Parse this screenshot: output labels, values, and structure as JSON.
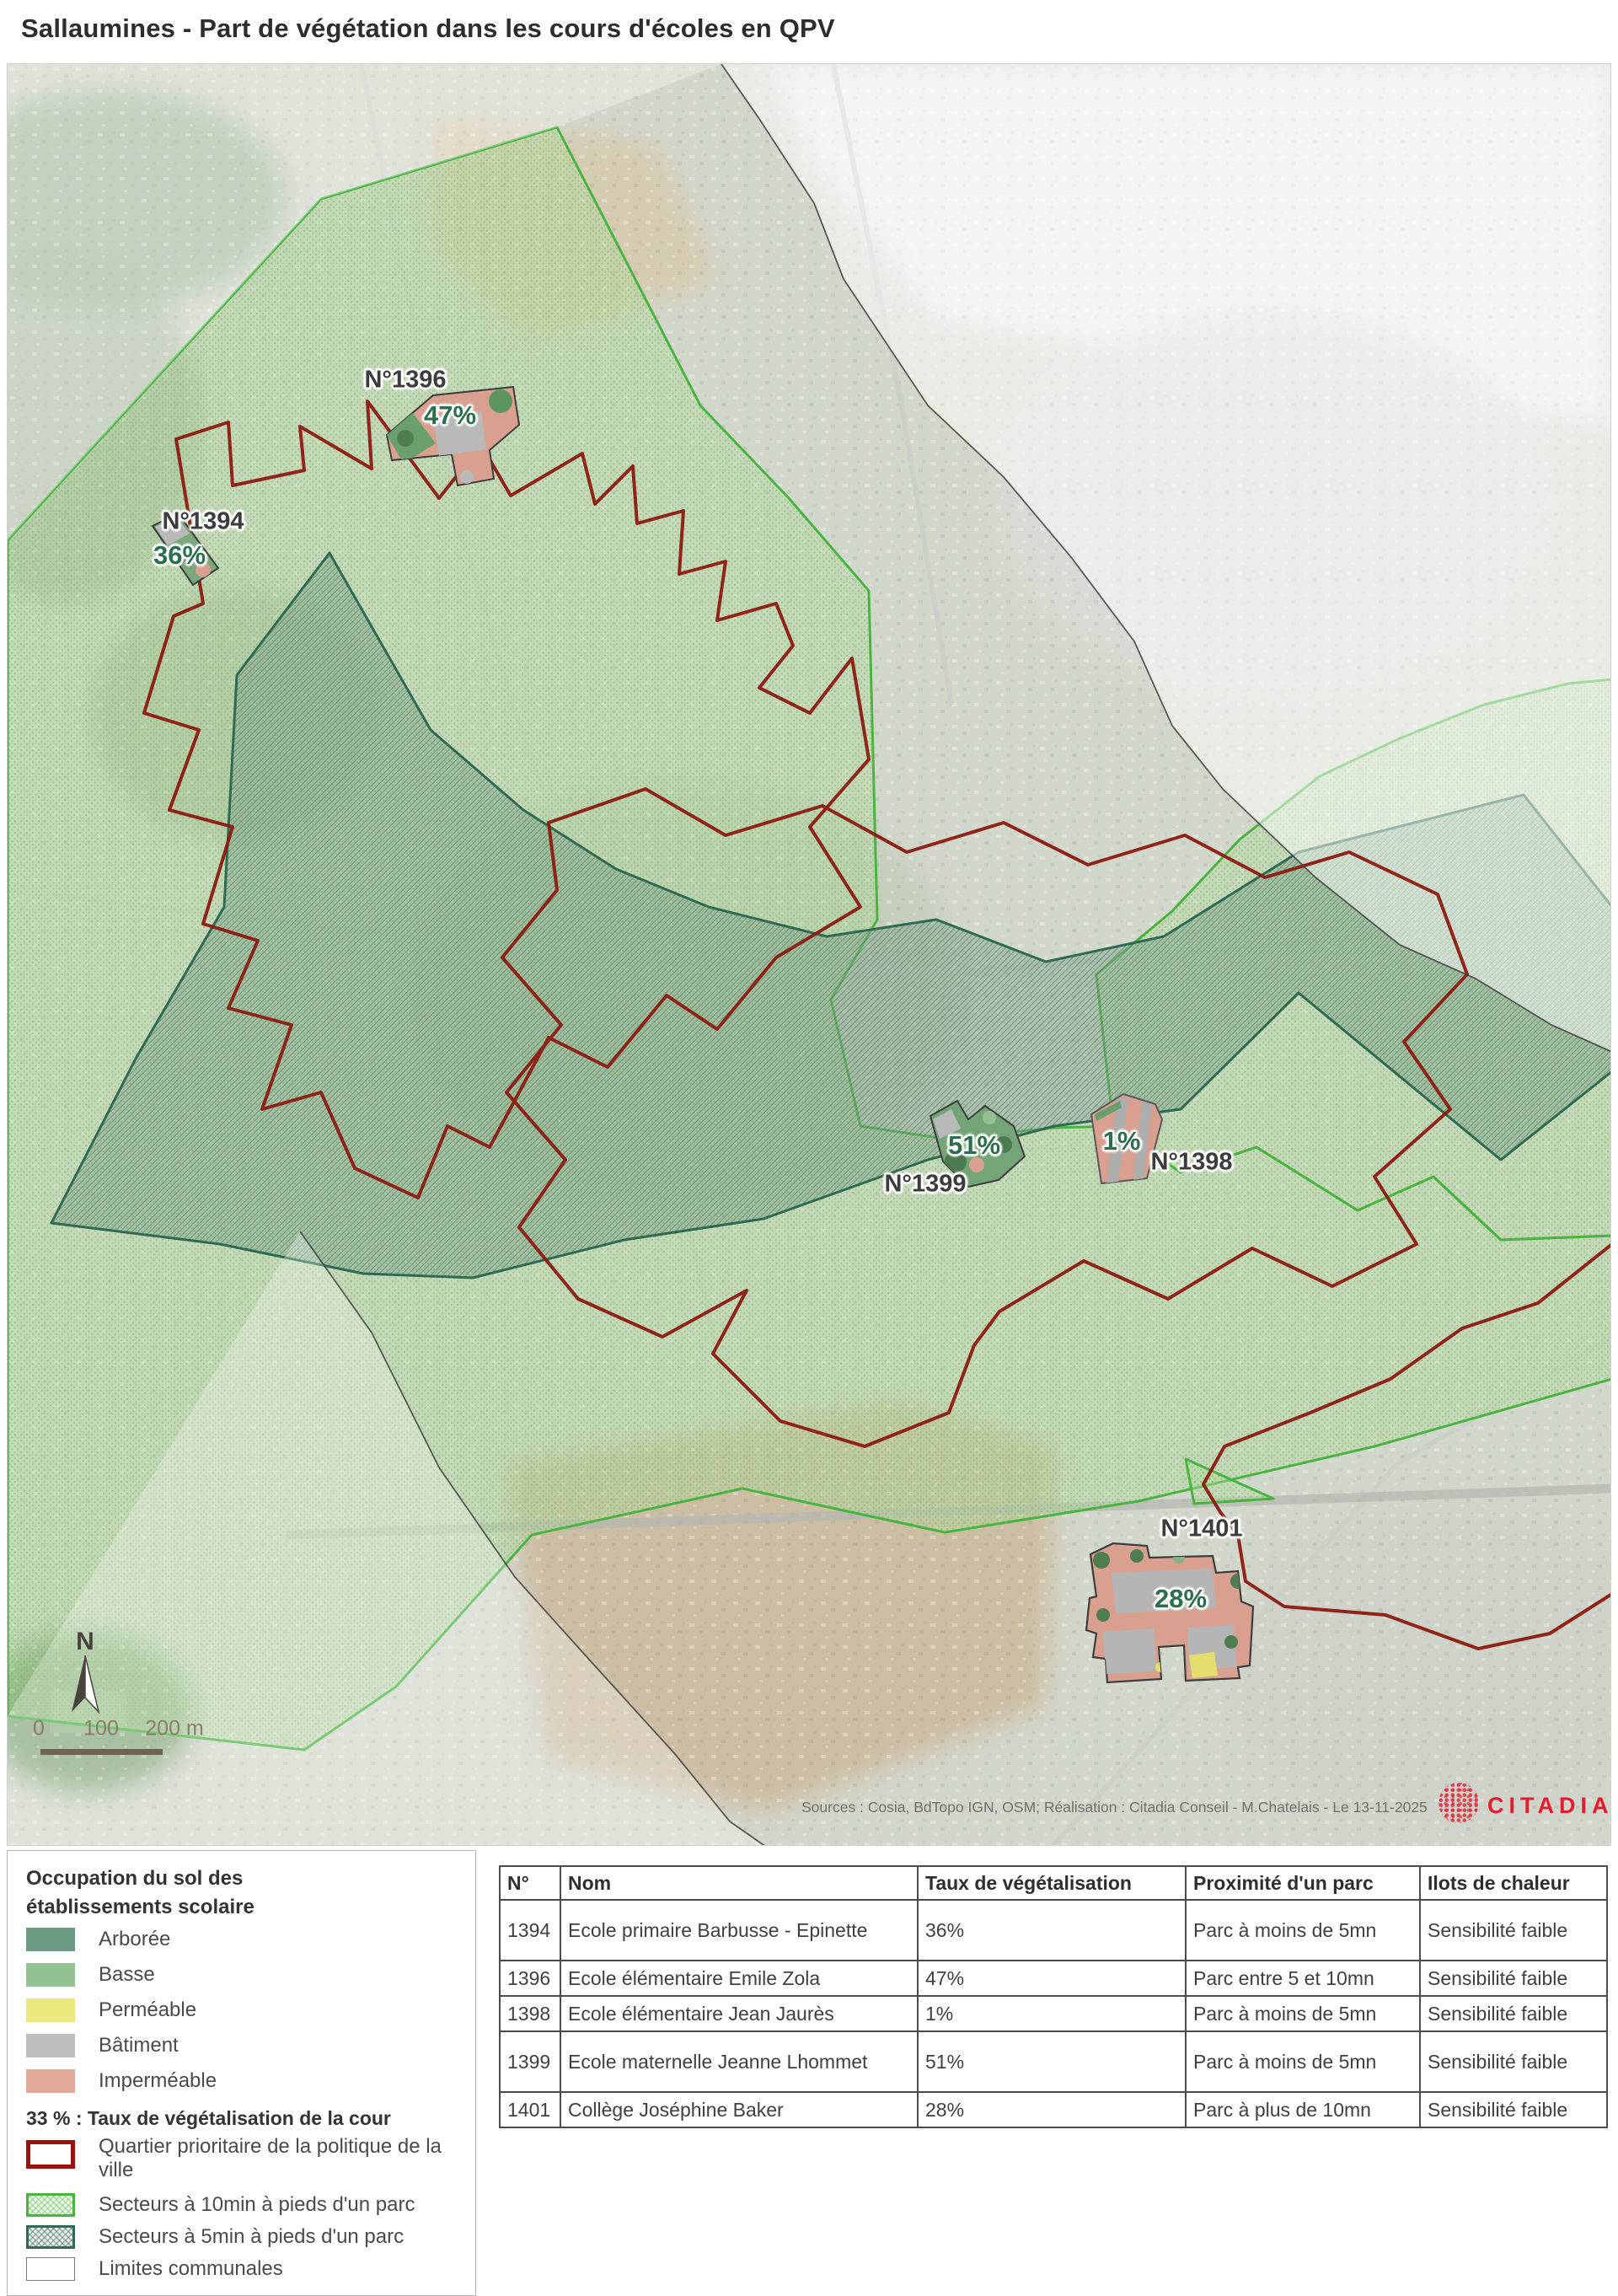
{
  "title": "Sallaumines - Part de végétation dans les cours d'écoles en QPV",
  "map": {
    "north_label": "N",
    "scale_ticks": [
      "0",
      "100",
      "200 m"
    ],
    "sources": "Sources : Cosia, BdTopo IGN, OSM; Réalisation : Citadia Conseil - M.Chatelais - Le 13-11-2025",
    "logo_text": "CITADIA",
    "schools": [
      {
        "id": "1394",
        "label": "N°1394",
        "pct": "36%"
      },
      {
        "id": "1396",
        "label": "N°1396",
        "pct": "47%"
      },
      {
        "id": "1398",
        "label": "N°1398",
        "pct": "1%"
      },
      {
        "id": "1399",
        "label": "N°1399",
        "pct": "51%"
      },
      {
        "id": "1401",
        "label": "N°1401",
        "pct": "28%"
      }
    ]
  },
  "legend": {
    "title_line1": "Occupation du sol des",
    "title_line2": "établissements scolaire",
    "items": [
      {
        "label": "Arborée",
        "color": "#6b9b82"
      },
      {
        "label": "Basse",
        "color": "#93c193"
      },
      {
        "label": "Perméable",
        "color": "#ebe87e"
      },
      {
        "label": "Bâtiment",
        "color": "#bdbdbd"
      },
      {
        "label": "Imperméable",
        "color": "#e2a89a"
      }
    ],
    "rate_note": "33 % : Taux de végétalisation de la cour",
    "outline_items": [
      {
        "label": "Quartier prioritaire de la politique de la ville",
        "border": "#9b120f"
      },
      {
        "label": "Secteurs à 10min à pieds d'un parc",
        "border": "#49b441"
      },
      {
        "label": "Secteurs à 5min à pieds d'un parc",
        "border": "#2e6b52"
      },
      {
        "label": "Limites communales",
        "border": "#777777"
      }
    ]
  },
  "table": {
    "headers": [
      "N°",
      "Nom",
      "Taux de végétalisation",
      "Proximité d'un parc",
      "Ilots de chaleur"
    ],
    "rows": [
      [
        "1394",
        "Ecole primaire Barbusse - Epinette",
        "36%",
        "Parc à moins de 5mn",
        "Sensibilité faible"
      ],
      [
        "1396",
        "Ecole élémentaire Emile Zola",
        "47%",
        "Parc entre 5 et 10mn",
        "Sensibilité faible"
      ],
      [
        "1398",
        "Ecole élémentaire Jean Jaurès",
        "1%",
        "Parc à moins de 5mn",
        "Sensibilité faible"
      ],
      [
        "1399",
        "Ecole maternelle Jeanne Lhommet",
        "51%",
        "Parc à moins de 5mn",
        "Sensibilité faible"
      ],
      [
        "1401",
        "Collège Joséphine Baker",
        "28%",
        "Parc à plus de 10mn",
        "Sensibilité faible"
      ]
    ]
  },
  "colors": {
    "qpv_boundary": "#8d1a10",
    "sector_10min_border": "#49b441",
    "sector_5min_border": "#2e6b52",
    "commune_border": "#3f3f3f",
    "logo_red": "#e8192c",
    "badge_green": "#2c6e4e"
  }
}
